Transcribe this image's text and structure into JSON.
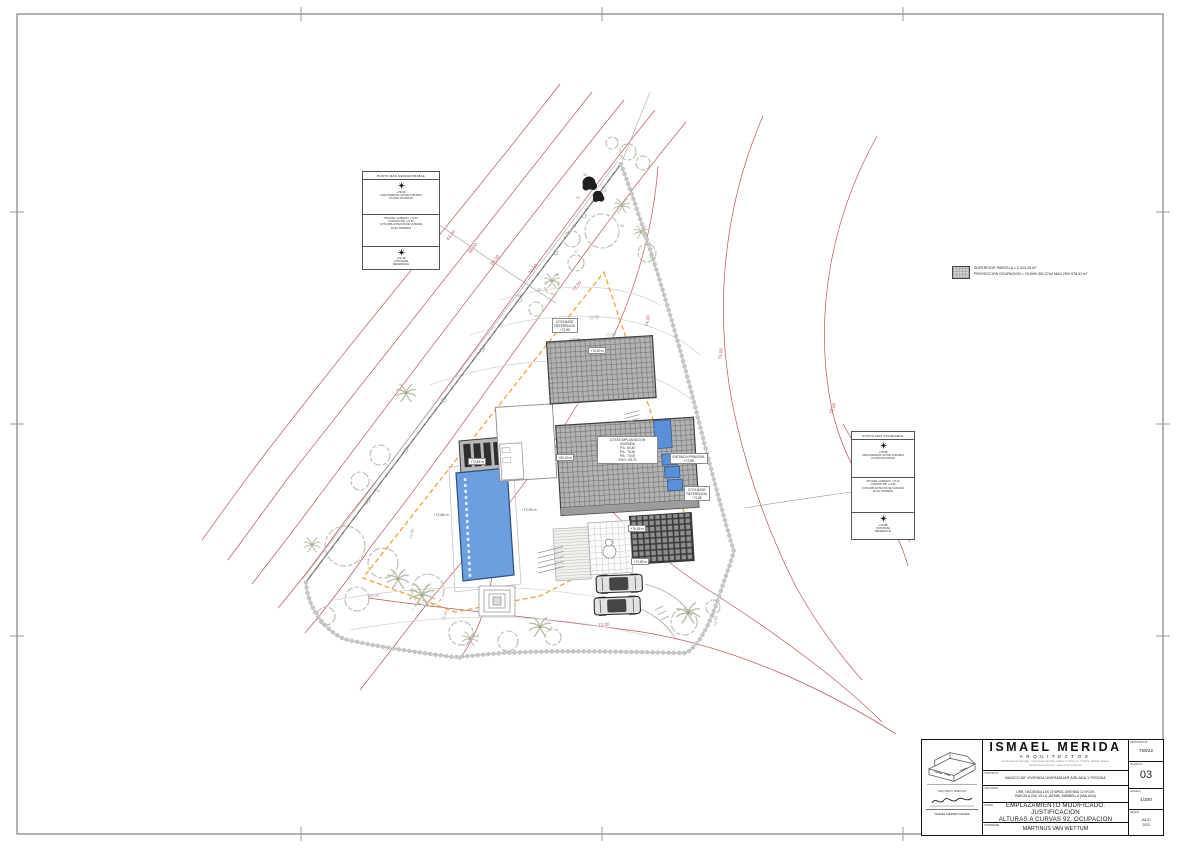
{
  "legend": {
    "line1": "SUPERFICIE PARCELA = 2.314,45 m²",
    "line2": "PROYECCION OCUPACION = 16,94% 392,27m² MAX 25% 578,61 m²"
  },
  "annotations": {
    "worst": {
      "title": "PUNTO MAS DESFAVORABLE",
      "s1_value": "+79.30",
      "s1_text": "CARA INFERIOR ULTIMO FORJADO\nPLANTA SOLARIUM",
      "s2_text": "PB NIVEL ACABADO: +73.00\nFORJADO PB: +72.85\nCOTA IMPLANTACION DE VIVIENDA\nEN EL TERRENO",
      "s3_value": "+72.10",
      "s3_text": "COTA BASE\nREFERENCIA"
    },
    "best": {
      "title": "PUNTO MAS FAVORABLE",
      "s1_value": "+79.30",
      "s1_text": "CARA INFERIOR ULTIMO FORJADO\nPLANTA SOLARIUM",
      "s2_text": "PB NIVEL ACABADO: +73.00\nFORJADO PB: +72.85\nCOTA IMPLANTACION DE VIVIENDA\nEN EL TERRENO",
      "s3_value": "+74.85",
      "s3_text": "COTA BASE\nREFERENCIA"
    }
  },
  "boxed_labels": [
    {
      "x": 588,
      "y": 347,
      "lines": [
        "+76,50 m"
      ]
    },
    {
      "x": 556,
      "y": 454,
      "lines": [
        "+80,00 m"
      ]
    },
    {
      "x": 628,
      "y": 525,
      "lines": [
        "+76,85 m"
      ]
    },
    {
      "x": 631,
      "y": 558,
      "lines": [
        "+72,85 m"
      ]
    },
    {
      "x": 468,
      "y": 458,
      "lines": [
        "+72,86 m"
      ]
    },
    {
      "x": 552,
      "y": 318,
      "lines": [
        "COTA BASE",
        "REFERENCIA",
        "+72,85"
      ]
    },
    {
      "x": 684,
      "y": 486,
      "lines": [
        "COTA BASE",
        "REFERENCIA",
        "+72,85"
      ]
    },
    {
      "x": 670,
      "y": 453,
      "lines": [
        "ENTRADA PRINCIPAL",
        "+72,86"
      ]
    },
    {
      "x": 597,
      "y": 436,
      "w": 56,
      "lines": [
        "COTAS IMPLANTACION",
        "VIVIENDA",
        "P.S.: 80,40",
        "P.A.: 76,50",
        "P.B.: 73,00",
        "P.SO.: 69,70"
      ]
    }
  ],
  "plan_labels": [
    {
      "t": "64,00",
      "x": 452,
      "y": 236,
      "r": -52,
      "c": "red"
    },
    {
      "t": "66,00",
      "x": 474,
      "y": 249,
      "r": -52,
      "c": "red"
    },
    {
      "t": "68,00",
      "x": 496,
      "y": 261,
      "r": -52,
      "c": "red"
    },
    {
      "t": "70,00",
      "x": 534,
      "y": 270,
      "r": -52,
      "c": "red"
    },
    {
      "t": "72,00",
      "x": 578,
      "y": 287,
      "r": -52,
      "c": "red"
    },
    {
      "t": "74,00",
      "x": 649,
      "y": 321,
      "r": -80,
      "c": "red"
    },
    {
      "t": "76,00",
      "x": 722,
      "y": 354,
      "r": -83,
      "c": "red"
    },
    {
      "t": "78,00",
      "x": 834,
      "y": 409,
      "r": -70,
      "c": "red"
    },
    {
      "t": "72,00",
      "x": 604,
      "y": 626,
      "r": -5,
      "c": "red"
    },
    {
      "t": "70,00",
      "x": 594,
      "y": 319,
      "r": -10,
      "c": "gray"
    },
    {
      "t": "71,00",
      "x": 611,
      "y": 336,
      "r": -10,
      "c": "gray"
    },
    {
      "t": "69,00",
      "x": 374,
      "y": 597,
      "r": -5,
      "c": "gray"
    },
    {
      "t": "71,00",
      "x": 446,
      "y": 616,
      "r": -72,
      "c": "gray"
    },
    {
      "t": "72,00",
      "x": 413,
      "y": 534,
      "r": -80,
      "c": "gray"
    },
    {
      "t": "73,00",
      "x": 717,
      "y": 621,
      "r": -85,
      "c": "gray"
    },
    {
      "t": "+73,65 m",
      "x": 577,
      "y": 341,
      "r": 0,
      "c": "dark"
    },
    {
      "t": "+73,35 m",
      "x": 529,
      "y": 511,
      "r": 0,
      "c": "dark"
    },
    {
      "t": "+72,86 m",
      "x": 441,
      "y": 516,
      "r": 0,
      "c": "dark"
    },
    {
      "t": "34",
      "x": 585,
      "y": 176,
      "r": 0,
      "c": "tree"
    },
    {
      "t": "33",
      "x": 578,
      "y": 199,
      "r": 0,
      "c": "tree"
    },
    {
      "t": "30",
      "x": 622,
      "y": 227,
      "r": 0,
      "c": "tree"
    },
    {
      "t": "31",
      "x": 651,
      "y": 258,
      "r": 0,
      "c": "tree"
    },
    {
      "t": "28",
      "x": 574,
      "y": 227,
      "r": 0,
      "c": "tree"
    },
    {
      "t": "27",
      "x": 576,
      "y": 253,
      "r": 0,
      "c": "tree"
    },
    {
      "t": "26",
      "x": 557,
      "y": 276,
      "r": 0,
      "c": "tree"
    },
    {
      "t": "25",
      "x": 539,
      "y": 291,
      "r": 0,
      "c": "tree"
    },
    {
      "t": "24",
      "x": 519,
      "y": 297,
      "r": 0,
      "c": "tree"
    },
    {
      "t": "22",
      "x": 483,
      "y": 349,
      "r": 0,
      "c": "tree"
    },
    {
      "t": "14",
      "x": 378,
      "y": 492,
      "r": 0,
      "c": "tree"
    },
    {
      "t": "13",
      "x": 366,
      "y": 504,
      "r": 0,
      "c": "tree"
    },
    {
      "t": "7",
      "x": 413,
      "y": 611,
      "r": 0,
      "c": "tree"
    },
    {
      "t": "3",
      "x": 478,
      "y": 637,
      "r": 0,
      "c": "tree"
    },
    {
      "t": "2",
      "x": 551,
      "y": 629,
      "r": 0,
      "c": "tree"
    },
    {
      "t": "1",
      "x": 689,
      "y": 612,
      "r": 0,
      "c": "tree"
    }
  ],
  "title_block": {
    "studio_name": "ISMAEL MERIDA",
    "studio_sub": "ARQUITECTOS",
    "addr1": "Arquitectura de Viviendas · Urbanización Rio Real, Edificio 2, Oficina 10, 1ª Planta, Marbella, Málaga",
    "addr2": "info@ismaelmerida.com  ·  www.ismaelmerida.com",
    "lbl_proyecto": "PROYECTO",
    "proyecto": "BASICO DE VIVIENDA UNIFAMILIAR AISLADA Y PISCINA",
    "lbl_situacion": "SITUACION",
    "situacion": "URB. HACIENDA LAS CHAPAS, AVENIDA 12 Nº13V,\nPARCELA 226, VILLA JAZMIN, MARBELLA (MALAGA)",
    "lbl_plano": "PLANO",
    "plano": "EMPLAZAMIENTO MODIFICADO. JUSTIFICACION\nALTURAS A CURVAS 92. OCUPACION",
    "lbl_propiedad": "PROPIEDAD",
    "propiedad": "MARTINUS VAN WETTUM",
    "lbl_proy_n": "PROYECTO Nº",
    "proy_n": "766/22",
    "lbl_plano_n": "PLANO Nº",
    "plano_n": "03",
    "lbl_escala": "ESCALA",
    "escala": "1/200",
    "lbl_fecha": "FECHA",
    "fecha": "JULIO\n2023",
    "director_label": "ARQUITECTO DIRECTOR",
    "director": "ISMAEL MERIDA GOMEZ"
  },
  "colors": {
    "contour_red": "#b5585a",
    "setback_orange": "#ee9d2e",
    "pool_blue": "#6d9ee0",
    "roof_gray": "#b3b3b3"
  }
}
